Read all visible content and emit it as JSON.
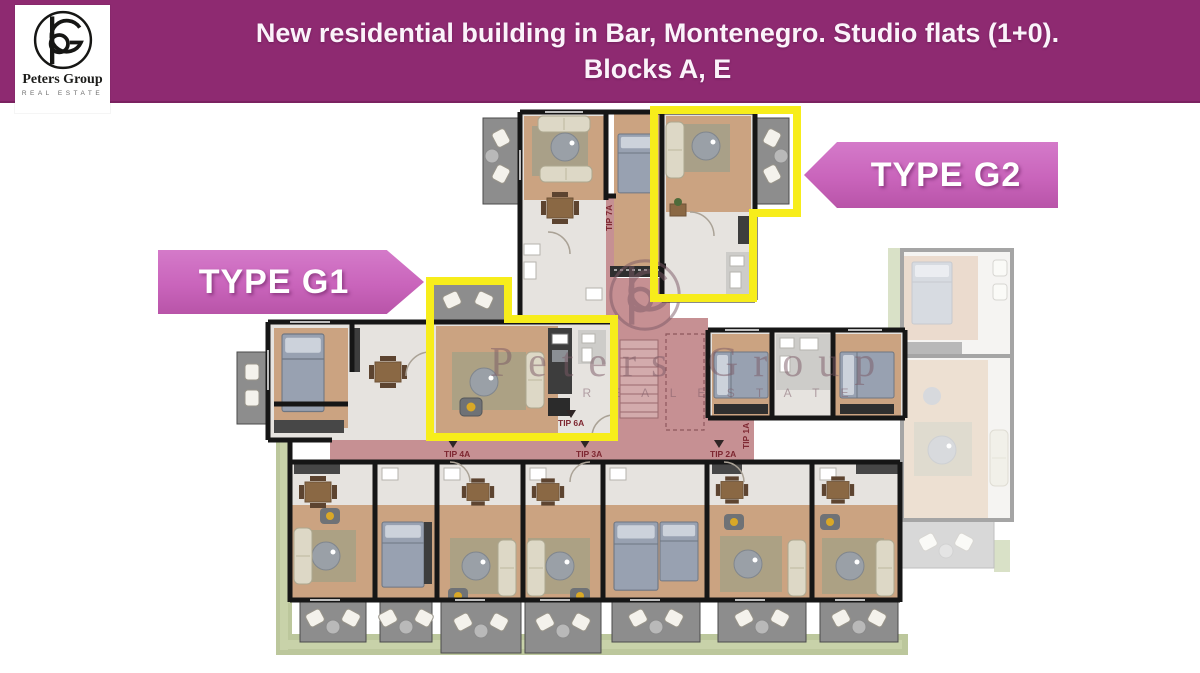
{
  "header": {
    "title_line1": "New residential building in Bar, Montenegro. Studio flats (1+0).",
    "title_line2": "Blocks A, E"
  },
  "logo": {
    "name": "Peters Group",
    "tagline": "REAL ESTATE"
  },
  "banners": {
    "g1": "TYPE G1",
    "g2": "TYPE G2"
  },
  "plan": {
    "watermark": {
      "name": "Peters Group",
      "tagline": "R E A L   E S T A T E"
    },
    "tags": [
      "TIP 7A",
      "TIP 6A",
      "TIP 4A",
      "TIP 3A",
      "TIP 2A",
      "TIP 1A"
    ],
    "colors": {
      "header_purple": "#8e2a71",
      "banner_pink": "#c964bb",
      "highlight_yellow": "#f7ed1b",
      "corridor_pink": "#c69093",
      "greenery_green": "#bcc79c",
      "wall_black": "#161616",
      "wood_floor": "#cba381",
      "balcony_gray": "#8d8d8d"
    }
  }
}
